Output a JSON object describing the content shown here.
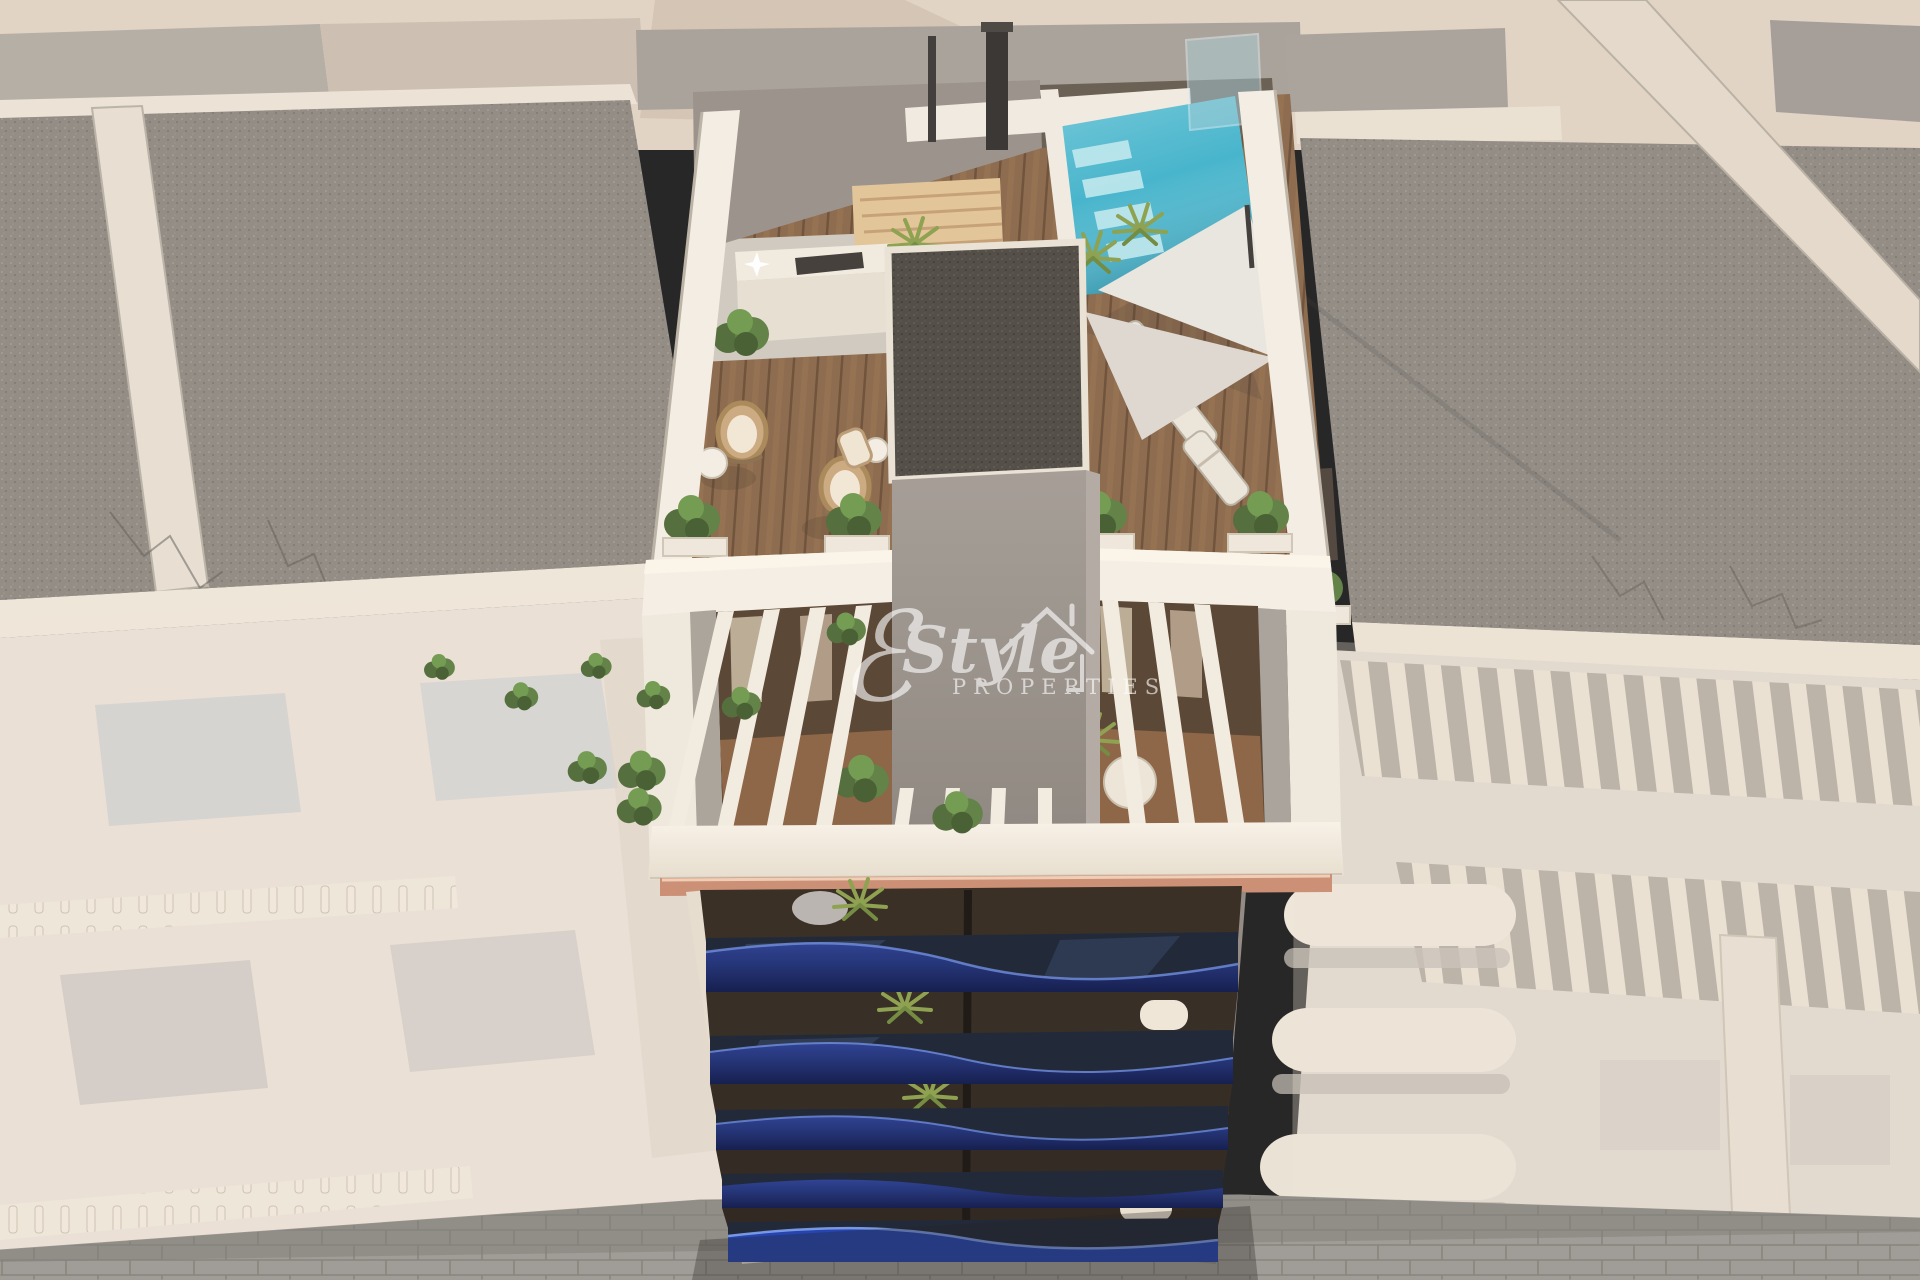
{
  "watermark": {
    "flourish_glyph": "ℰ",
    "script_text": "Style",
    "caps_text": "PROPERTIES"
  },
  "palette": {
    "ground_beige": "#e0d4c3",
    "far_wall_gray": "#a8a29a",
    "gravel_gray": "#8f8a83",
    "parapet_white": "#f4eee3",
    "left_facade_cream": "#e8dfd4",
    "right_facade_cream": "#ddd6cc",
    "core_gray": "#9c958e",
    "core_roof_dark": "#4e4942",
    "wood_deck_brown": "#8a684a",
    "pergola_wood": "#e2c497",
    "pool_turquoise": "#41b4cc",
    "pool_step_light": "#bfe9ef",
    "sail_white": "#e9e5df",
    "plant_green": "#55713b",
    "awning_copper": "#c98d72",
    "balcony_navy": "#16266b",
    "balcony_navy_bright": "#1e3fae",
    "balcony_glass_dark": "#1a2334",
    "pavement_gray": "#9b9893",
    "watermark_white": "#ffffff"
  }
}
